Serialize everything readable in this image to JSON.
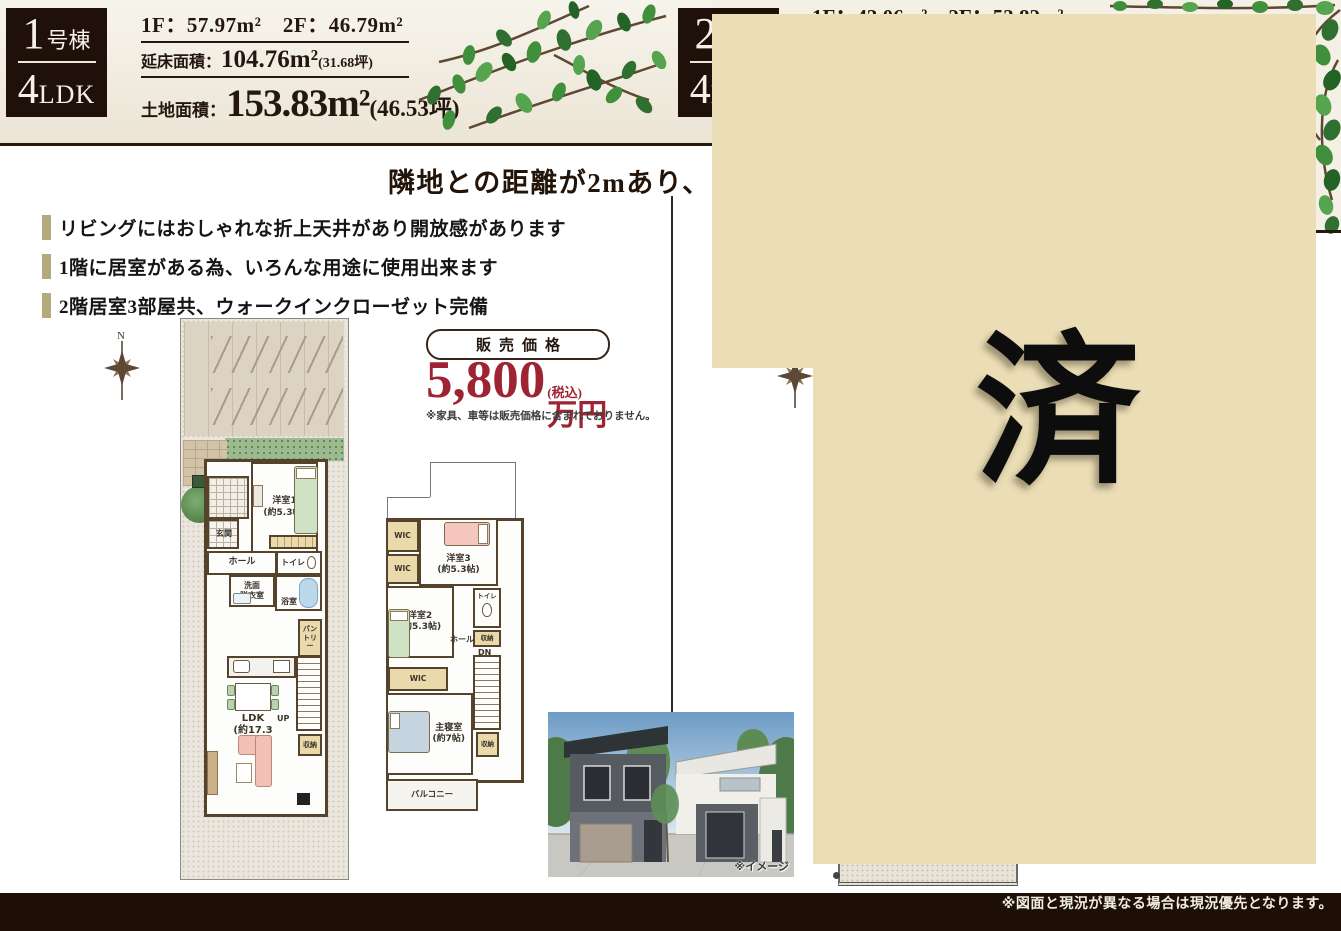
{
  "colors": {
    "overlay_beige": "#ebdeb6",
    "price_red": "#9e2433",
    "bullet_bar": "#b2a97c",
    "badge_bg": "#20100a",
    "banner_cream": "#f4f0e6",
    "footer_bg": "#1d0f06"
  },
  "banner": {
    "b1": {
      "num": "1",
      "num_suffix": "号棟",
      "plan_num": "4",
      "plan_suffix": "LDK",
      "floors": "1F：57.97m²　2F：46.79m²",
      "total_label": "延床面積：",
      "total_value": "104.76m²",
      "total_tsubo": "(31.68坪)",
      "land_label": "土地面積：",
      "land_value": "153.83m²",
      "land_tsubo": "(46.53坪)"
    },
    "b2": {
      "num": "2",
      "num_suffix": "号棟",
      "plan_num": "4",
      "plan_suffix": "LDK",
      "floors": "1F：43.06m²　2F：53.82m²"
    }
  },
  "headline": "隣地との距離が2mあり、ゆとりの",
  "features": [
    "リビングにはおしゃれな折上天井があり開放感があります",
    "1階に居室がある為、いろんな用途に使用出来ます",
    "2階居室3部屋共、ウォークインクローゼット完備"
  ],
  "price": {
    "label": "販売価格",
    "amount": "5,800",
    "tax": "(税込)",
    "unit": "万円",
    "note": "※家具、車等は販売価格に含まれておりません。"
  },
  "compass": {
    "north": "N"
  },
  "plan1f": {
    "room1": "洋室1\n(約5.3帖)",
    "genkan": "玄関",
    "hall": "ホール",
    "toilet": "トイレ",
    "washroom": "洗面\n脱衣室",
    "bath": "浴室",
    "pantry": "パン\nトリー",
    "ldk": "LDK\n(約17.3帖)",
    "up": "UP",
    "storage": "収納"
  },
  "plan2f": {
    "wic_a": "WIC",
    "wic_b": "WIC",
    "wic_c": "WIC",
    "room3": "洋室3\n(約5.3帖)",
    "room2": "洋室2\n(約5.3帖)",
    "toilet": "トイレ",
    "storage_a": "収納",
    "hall": "ホール",
    "dn": "DN",
    "master": "主寝室\n(約7帖)",
    "storage_b": "収納",
    "balcony": "バルコニー"
  },
  "photo": {
    "caption": "※イメージ"
  },
  "sold_stamp": "済",
  "footer": {
    "note": "※図面と現況が異なる場合は現況優先となります。"
  }
}
